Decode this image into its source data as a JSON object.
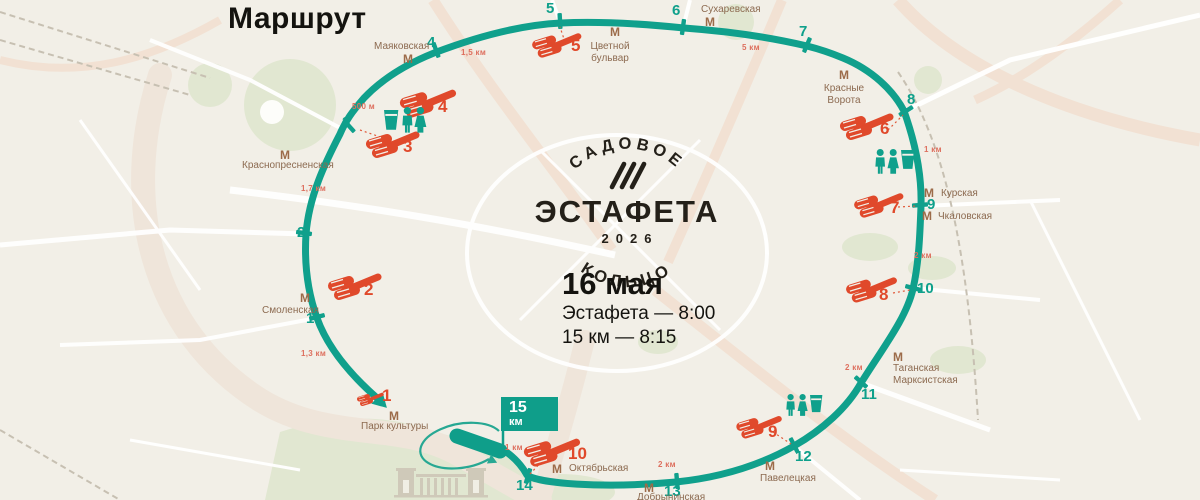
{
  "title": "Маршрут",
  "logo": {
    "arc_top": "САДОВОЕ",
    "name": "ЭСТАФЕТА",
    "year": "2026",
    "arc_bottom": "КОЛЬЦО"
  },
  "event": {
    "date": "16 мая",
    "relay_time": "Эстафета — 8:00",
    "fifteen_km_time": "15 км — 8:15"
  },
  "finish_flag": {
    "value": "15",
    "unit": "км"
  },
  "metro_letter": "М",
  "km_markers": [
    "1",
    "2",
    "3",
    "4",
    "5",
    "6",
    "7",
    "8",
    "9",
    "10",
    "11",
    "12",
    "13",
    "14"
  ],
  "exchange_points": [
    "1",
    "2",
    "3",
    "4",
    "5",
    "6",
    "7",
    "8",
    "9",
    "10"
  ],
  "metro_stations": [
    "Маяковская",
    "Цветной\nбульвар",
    "Сухаревская",
    "Красные\nВорота",
    "Курская",
    "Чкаловская",
    "Таганская\nМарксистская",
    "Павелецкая",
    "Добрынинская",
    "Октябрьская",
    "Парк культуры",
    "Смоленская",
    "Краснопресненская"
  ],
  "distance_labels": [
    "500 м",
    "1,5 км",
    "5 км",
    "1 км",
    "2 км",
    "2 км",
    "2 км",
    "1 км",
    "1,3 км",
    "1,7 км"
  ],
  "colors": {
    "route": "#10a08c",
    "exchange": "#e0492b",
    "metro": "#9c6b49",
    "background": "#f2efe7"
  }
}
